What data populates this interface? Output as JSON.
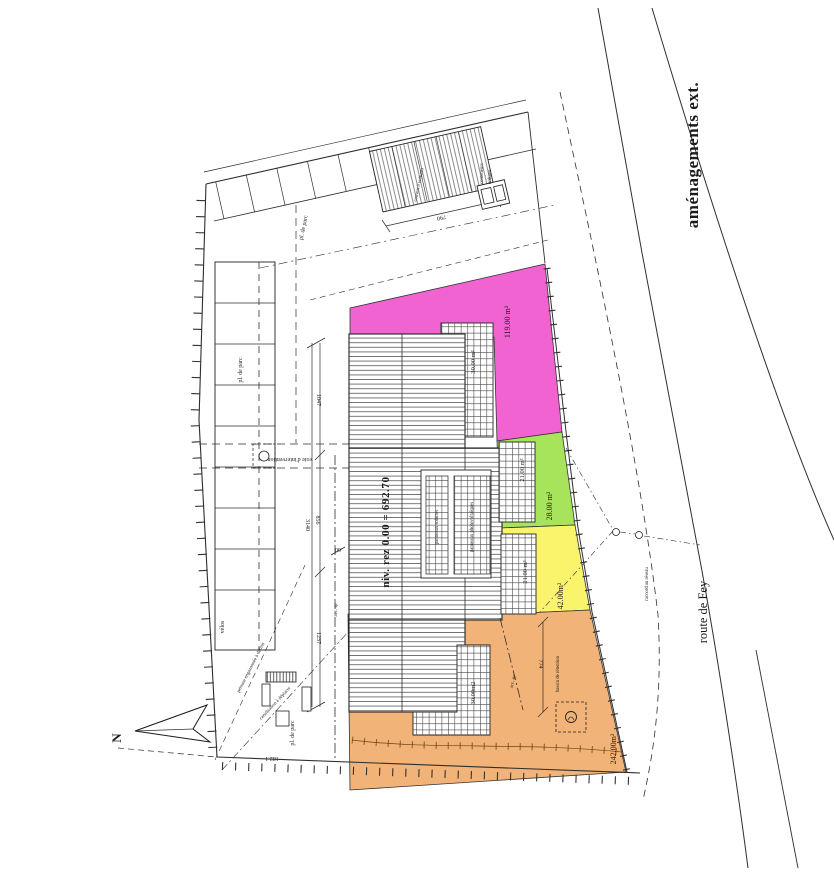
{
  "plan": {
    "title": "aménagements ext.",
    "street": "route de Fey",
    "north": "N",
    "level": "niv. rez 0.00 = 692.70"
  },
  "zones": {
    "pink": {
      "label": "119.00 m²",
      "color": "#f263d2"
    },
    "green": {
      "label": "28.00 m²",
      "color": "#a8e35c"
    },
    "yellow": {
      "label": "42.00m²",
      "color": "#faf46c"
    },
    "orange": {
      "label": "242.00m²",
      "color": "#f1b377"
    }
  },
  "terraces": {
    "top": "30.00 m²",
    "green": "21.00 m²",
    "yellow": "21.00 m²",
    "bottom": "30.00m2"
  },
  "building": {
    "solar": "panneaux solaires",
    "photovoltaic": "panneaux photovoltaïques"
  },
  "site": {
    "parking_top": "pl. de parc",
    "parking_left": "pl. de parc",
    "parking_bottom": "pl. de parc",
    "bikes": "vélos",
    "carport": "couvert à voitures",
    "containers_1": "conteneurs",
    "containers_2": "ordures",
    "basin": "bassin de rétention",
    "fire_lane": "voie d'intervention",
    "access_1": "acc. sp",
    "access_2": "acc. sp",
    "network": "raccord au réseau",
    "note_a": "pelouse engazonnée à définir",
    "note_b": "canalisation à déplacer"
  },
  "dims": {
    "carport": "790",
    "d1047": "1047",
    "d856": "856",
    "d3140": "3140",
    "d1237": "1237",
    "d60": "60",
    "d774": "774",
    "bottom": "182.1"
  }
}
